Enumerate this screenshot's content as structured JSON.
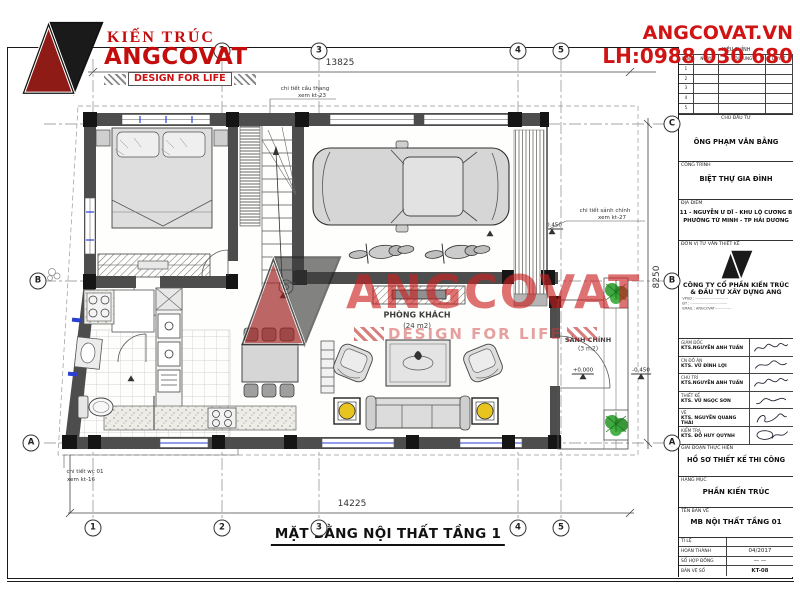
{
  "header": {
    "logo": {
      "top": "KIẾN TRÚC",
      "name": "ANGCOVAT",
      "tagline": "DESIGN FOR LIFE"
    },
    "contact": {
      "site": "ANGCOVAT.VN",
      "phone": "LH:0988 030 680"
    }
  },
  "watermark": {
    "name": "ANGCOVAT",
    "tagline": "DESIGN FOR LIFE"
  },
  "plan": {
    "title": "MẶT BẰNG NỘI THẤT TẦNG 1",
    "rooms": [
      {
        "name": "P.NGỦ 01",
        "area": "(12 m2)"
      },
      {
        "name": "GARA",
        "area": "(19 m2)"
      },
      {
        "name": "PHÒNG KHÁCH",
        "area": "(24 m2)"
      },
      {
        "name": "P.BẾP + ĂN",
        "area": "(15 m2)"
      },
      {
        "name": "SẢNH CHÍNH",
        "area": "(3 m2)"
      }
    ],
    "dims": {
      "top": "13825",
      "bottom": "14225",
      "right": "8250"
    },
    "grid_cols": [
      "1",
      "2",
      "3",
      "4",
      "5"
    ],
    "grid_rows": [
      "A",
      "B",
      "C"
    ],
    "levels": {
      "garage": "-0.300",
      "ramp": "-0.450",
      "stair": "+0.000",
      "wc": "-0.020",
      "porch": "+0.000",
      "outside": "-0.450"
    },
    "notes": {
      "stair": {
        "l1": "chi tiết cầu thang",
        "l2": "xem kt-23"
      },
      "porch": {
        "l1": "chi tiết sảnh chính",
        "l2": "xem kt-27"
      },
      "wc": {
        "l1": "chi tiết wc 01",
        "l2": "xem kt-16"
      }
    },
    "stair_steps": [
      "1",
      "2",
      "3",
      "4",
      "5",
      "6",
      "7",
      "8",
      "9",
      "10",
      "11"
    ]
  },
  "titleblock": {
    "revision": {
      "title": "HIỆU CHỈNH",
      "cols": [
        "LẦN",
        "NGÀY",
        "NỘI DUNG",
        "DUYỆT"
      ],
      "rows": [
        "1",
        "2",
        "3",
        "4",
        "5"
      ]
    },
    "owner_label": "CHỦ ĐẦU TƯ",
    "owner": "ÔNG PHẠM VĂN BẰNG",
    "project_label": "CÔNG TRÌNH",
    "project": "BIỆT THỰ GIA ĐÌNH",
    "location_label": "ĐỊA ĐIỂM",
    "location1": "11 - NGUYỄN Ư DĨ - KHU LỘ CƯƠNG B",
    "location2": "PHƯỜNG TỨ MINH - TP HẢI DƯƠNG",
    "firm_label": "ĐƠN VỊ TƯ VẤN THIẾT KẾ",
    "firm_name1": "CÔNG TY CỔ PHẦN KIẾN TRÚC",
    "firm_name2": "& ĐẦU TƯ XÂY DỰNG ANG",
    "firm_addr1": "VPGD : ······························",
    "firm_addr2": "ĐT : ··································",
    "firm_addr3": "EMAIL : ANGCOVAT···············",
    "signatures": [
      {
        "role": "GIÁM ĐỐC",
        "name": "KTS.NGUYỄN ANH TUẤN"
      },
      {
        "role": "CN ĐỒ ÁN",
        "name": "KTS. VŨ ĐÌNH LỢI"
      },
      {
        "role": "CHỦ TRÌ",
        "name": "KTS.NGUYỄN ANH TUẤN"
      },
      {
        "role": "THIẾT KẾ",
        "name": "KTS. VŨ NGỌC SƠN"
      },
      {
        "role": "VẼ",
        "name": "KTS. NGUYỄN QUANG THÁI"
      },
      {
        "role": "KIỂM TRA",
        "name": "KTS. ĐỖ HUY QUỲNH"
      }
    ],
    "stage_label": "GIAI ĐOẠN THỰC HIỆN",
    "stage": "HỒ SƠ THIẾT KẾ THI CÔNG",
    "category_label": "HẠNG MỤC",
    "category": "PHẦN KIẾN TRÚC",
    "drawing_label": "TÊN BẢN VẼ",
    "drawing": "MB NỘI THẤT TẦNG 01",
    "footer": [
      {
        "label": "TỈ LỆ",
        "value": ""
      },
      {
        "label": "HOÀN THÀNH",
        "value": "04/2017"
      },
      {
        "label": "SỐ HỢP ĐỒNG",
        "value": "— —"
      },
      {
        "label": "BẢN VẼ SỐ",
        "value": "KT-08"
      }
    ]
  }
}
